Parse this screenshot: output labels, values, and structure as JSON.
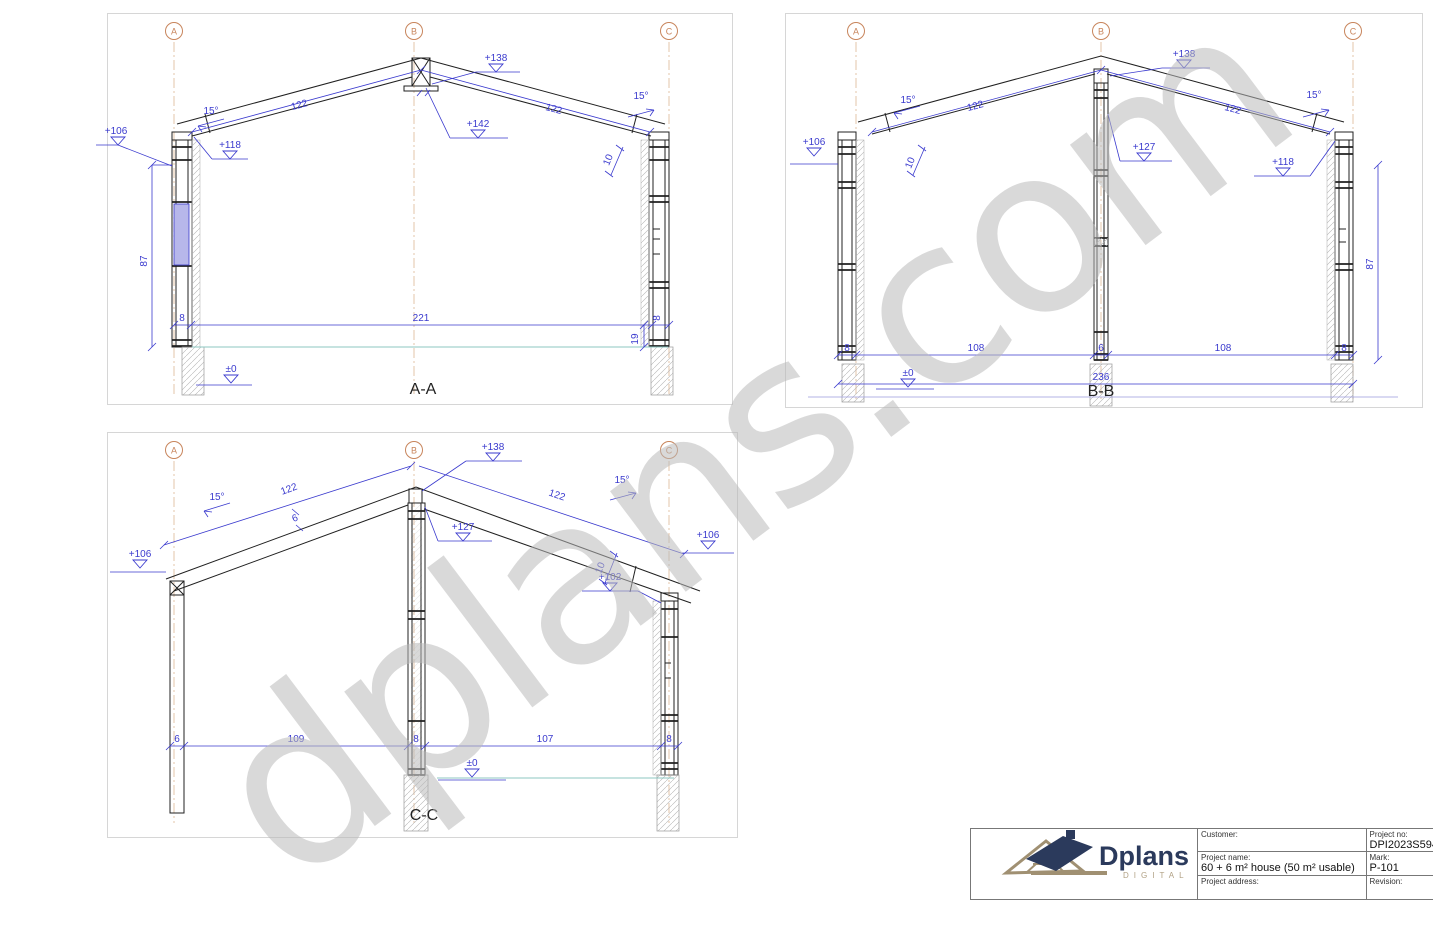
{
  "watermark": {
    "text": "dplans.com"
  },
  "colors": {
    "dimension_blue": "#3a3ace",
    "grid_orange": "#c8855c",
    "floor_teal": "#8cc7c2",
    "window_fill": "#b7b7ea",
    "logo_navy": "#2b3a5c",
    "logo_tan": "#b1a184",
    "watermark_gray": "#bababa"
  },
  "sections": {
    "aa": {
      "label": "A-A",
      "grid": [
        "A",
        "B",
        "C"
      ],
      "annotations": [
        {
          "t": "+106",
          "x": 8,
          "y": 120,
          "name": "level-label"
        },
        {
          "t": "+118",
          "x": 122,
          "y": 134,
          "name": "level-label"
        },
        {
          "t": "+138",
          "x": 388,
          "y": 47,
          "name": "level-label"
        },
        {
          "t": "+142",
          "x": 370,
          "y": 113,
          "name": "level-label"
        },
        {
          "t": "±0",
          "x": 123,
          "y": 358,
          "name": "level-label"
        },
        {
          "t": "15°",
          "x": 103,
          "y": 100,
          "name": "angle-label"
        },
        {
          "t": "15°",
          "x": 533,
          "y": 85,
          "name": "angle-label"
        },
        {
          "t": "122",
          "x": 192,
          "y": 94,
          "rot": -15
        },
        {
          "t": "122",
          "x": 445,
          "y": 98,
          "rot": 15
        },
        {
          "t": "10",
          "x": 503,
          "y": 147,
          "rot": -68
        },
        {
          "t": "87",
          "x": 39,
          "y": 247,
          "rot": -90
        },
        {
          "t": "8",
          "x": 74,
          "y": 307
        },
        {
          "t": "221",
          "x": 313,
          "y": 307
        },
        {
          "t": "19",
          "x": 530,
          "y": 325,
          "rot": -90
        },
        {
          "t": "8",
          "x": 552,
          "y": 304,
          "rot": -90
        }
      ]
    },
    "bb": {
      "label": "B-B",
      "grid": [
        "A",
        "B",
        "C"
      ],
      "annotations": [
        {
          "t": "+106",
          "x": 28,
          "y": 131,
          "name": "level-label"
        },
        {
          "t": "+138",
          "x": 398,
          "y": 43,
          "name": "level-label"
        },
        {
          "t": "+127",
          "x": 358,
          "y": 136,
          "name": "level-label"
        },
        {
          "t": "+118",
          "x": 497,
          "y": 151,
          "name": "level-label"
        },
        {
          "t": "±0",
          "x": 122,
          "y": 362,
          "name": "level-label"
        },
        {
          "t": "15°",
          "x": 122,
          "y": 89,
          "name": "angle-label"
        },
        {
          "t": "15°",
          "x": 528,
          "y": 84,
          "name": "angle-label"
        },
        {
          "t": "122",
          "x": 190,
          "y": 95,
          "rot": -15
        },
        {
          "t": "122",
          "x": 446,
          "y": 98,
          "rot": 15
        },
        {
          "t": "10",
          "x": 127,
          "y": 150,
          "rot": -68
        },
        {
          "t": "87",
          "x": 587,
          "y": 250,
          "rot": -90
        },
        {
          "t": "8",
          "x": 61,
          "y": 337
        },
        {
          "t": "108",
          "x": 190,
          "y": 337
        },
        {
          "t": "6",
          "x": 315,
          "y": 337
        },
        {
          "t": "108",
          "x": 437,
          "y": 337
        },
        {
          "t": "8",
          "x": 558,
          "y": 337
        },
        {
          "t": "236",
          "x": 315,
          "y": 366
        }
      ]
    },
    "cc": {
      "label": "C-C",
      "grid": [
        "A",
        "B",
        "C"
      ],
      "annotations": [
        {
          "t": "+106",
          "x": 32,
          "y": 124,
          "name": "level-label"
        },
        {
          "t": "+138",
          "x": 385,
          "y": 17,
          "name": "level-label"
        },
        {
          "t": "+127",
          "x": 355,
          "y": 97,
          "name": "level-label"
        },
        {
          "t": "+102",
          "x": 502,
          "y": 147,
          "name": "level-label"
        },
        {
          "t": "+106",
          "x": 600,
          "y": 105,
          "name": "level-label"
        },
        {
          "t": "±0",
          "x": 364,
          "y": 333,
          "name": "level-label"
        },
        {
          "t": "15°",
          "x": 109,
          "y": 67,
          "name": "angle-label"
        },
        {
          "t": "15°",
          "x": 514,
          "y": 50,
          "name": "angle-label"
        },
        {
          "t": "122",
          "x": 182,
          "y": 59,
          "rot": -20
        },
        {
          "t": "122",
          "x": 448,
          "y": 65,
          "rot": 19
        },
        {
          "t": "6",
          "x": 188,
          "y": 88,
          "rot": -20
        },
        {
          "t": "10",
          "x": 495,
          "y": 136,
          "rot": -68
        },
        {
          "t": "6",
          "x": 69,
          "y": 309
        },
        {
          "t": "109",
          "x": 188,
          "y": 309
        },
        {
          "t": "8",
          "x": 308,
          "y": 309
        },
        {
          "t": "107",
          "x": 437,
          "y": 309
        },
        {
          "t": "8",
          "x": 561,
          "y": 309
        }
      ]
    }
  },
  "title_block": {
    "logo": {
      "name": "Dplans",
      "sub": "DIGITAL"
    },
    "customer_label": "Customer:",
    "customer_value": "",
    "project_no_label": "Project no:",
    "project_no_value": "DPI2023S594",
    "project_name_label": "Project name:",
    "project_name_value": "60 + 6 m² house (50 m² usable)",
    "mark_label": "Mark:",
    "mark_value": "P-101",
    "project_address_label": "Project address:",
    "project_address_value": "",
    "revision_label": "Revision:",
    "revision_value": ""
  }
}
